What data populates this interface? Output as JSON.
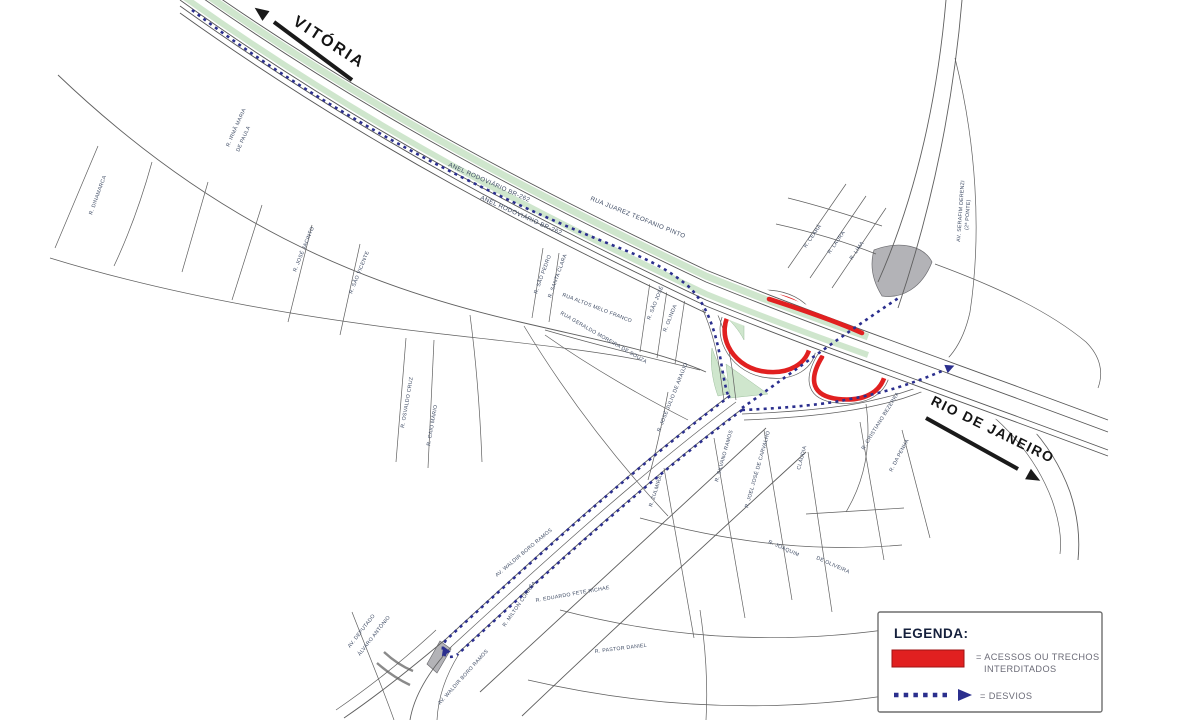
{
  "directions": {
    "vitoria": "VITÓRIA",
    "rio": "RIO DE JANEIRO"
  },
  "highways": {
    "anel_1": "ANEL RODOVIÁRIO BR-262",
    "anel_2": "ANEL RODOVIÁRIO BR-262",
    "juarez": "RUA JUAREZ TEOFANIO PINTO"
  },
  "streets": {
    "dinamarca": "R. DINAMARCA",
    "irma1": "R. IRMÃ MARIA",
    "irma2": "DE PAULA",
    "jose_jacinto": "R. JOSÉ JACINTO",
    "sao_vicente": "R. SÃO VICENTE",
    "osvaldo": "R. OSVALDO CRUZ",
    "caio": "R. CAIO MÁRIO",
    "sao_pedro": "R. SÃO PEDRO",
    "santa_clara": "R. SANTA CLARA",
    "altos_melo": "RUA ALTOS MELO FRANCO",
    "geraldo": "RUA GERALDO MOREIRA DE SOUZA",
    "sao_jose": "R. SÃO JOSÉ",
    "olinda": "R. OLINDA",
    "jose_julio": "R. JOSÉ JÚLIO DE ARAÚJO",
    "waldir1": "AV. WALDIR BORO RAMOS",
    "waldir2": "AV. WALDIR BORO RAMOS",
    "deputado1": "AV. DEPUTADO",
    "deputado2": "ÁLVARO ANTÔNIO",
    "milton": "R. MILTON CORRÊA",
    "eduardo": "R. EDUARDO FETE RICHAE",
    "pastor": "R. PASTOR DANIEL",
    "joaquim": "R. JOAQUIM",
    "oliveira": "DE OLIVEIRA",
    "zulmira": "R. ZULMIRA",
    "claudia": "CLÁUDIA",
    "joel": "R. JOEL JOSÉ DE CARVALHO",
    "silvano": "R. SILVANO RAMOS",
    "penha": "R. DA PENHA",
    "cristiano": "R. CRISTIANO BEZERRA",
    "serafim1": "AV. SERAFIM DERENZI",
    "serafim2": "(2ª PONTE)",
    "ceara": "R. CEARÁ",
    "laura": "R. LAURA",
    "lima": "R. LIMA"
  },
  "legend": {
    "title": "LEGENDA:",
    "closed_label_line1": "= ACESSOS OU TRECHOS",
    "closed_label_line2": "INTERDITADOS",
    "detour_label": "= DESVIOS"
  },
  "colors": {
    "closed_red": "#e12020",
    "detour_blue": "#2b2f8e",
    "median_green": "#cfe6cd",
    "island_gray": "#b3b3b7"
  }
}
